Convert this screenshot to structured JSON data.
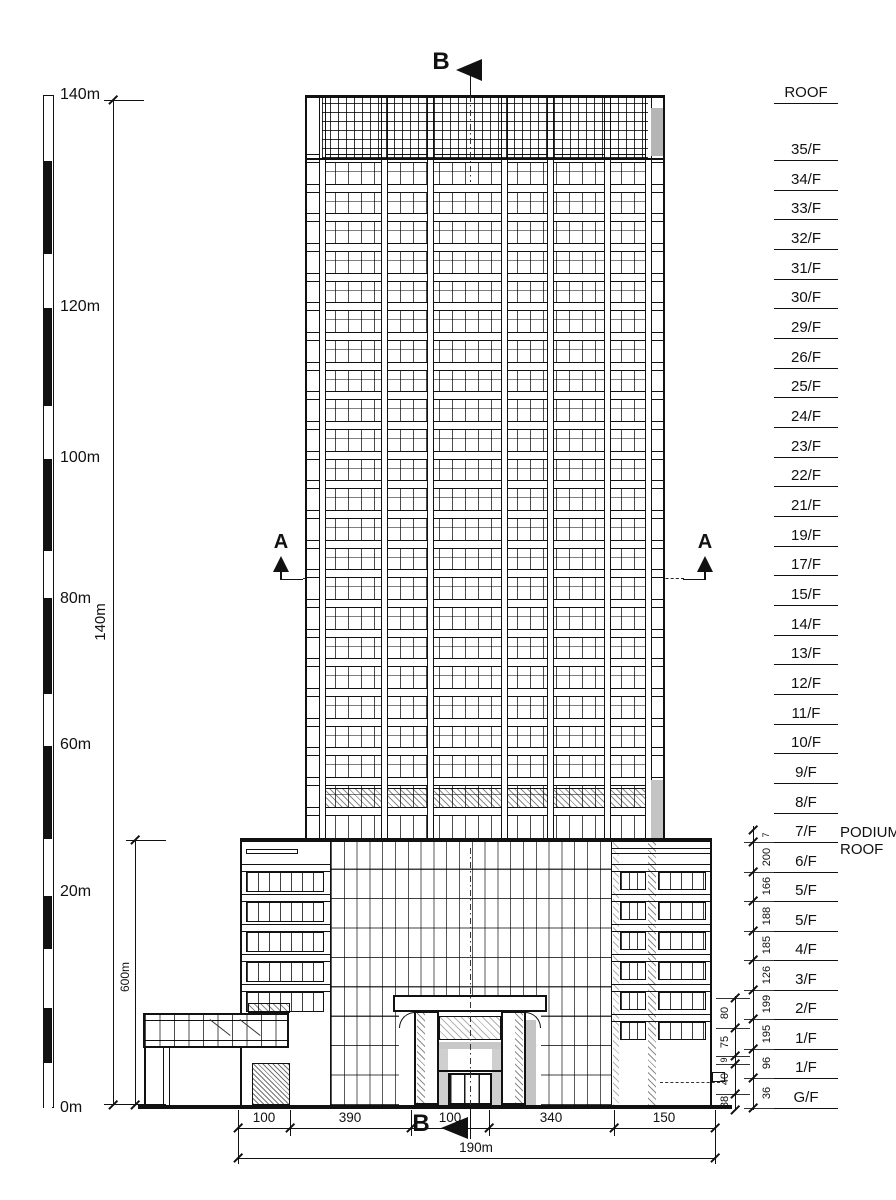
{
  "scale_bar": {
    "unit_labels": [
      {
        "text": "140m",
        "y": 95
      },
      {
        "text": "120m",
        "y": 307
      },
      {
        "text": "100m",
        "y": 458
      },
      {
        "text": "80m",
        "y": 599
      },
      {
        "text": "60m",
        "y": 745
      },
      {
        "text": "20m",
        "y": 892
      },
      {
        "text": "0m",
        "y": 1108
      }
    ],
    "segments": [
      {
        "y": 95,
        "h": 65,
        "fill": "white"
      },
      {
        "y": 160,
        "h": 93,
        "fill": "black"
      },
      {
        "y": 253,
        "h": 54,
        "fill": "white"
      },
      {
        "y": 307,
        "h": 98,
        "fill": "black"
      },
      {
        "y": 405,
        "h": 53,
        "fill": "white"
      },
      {
        "y": 458,
        "h": 92,
        "fill": "black"
      },
      {
        "y": 550,
        "h": 47,
        "fill": "white"
      },
      {
        "y": 597,
        "h": 96,
        "fill": "black"
      },
      {
        "y": 693,
        "h": 52,
        "fill": "white"
      },
      {
        "y": 745,
        "h": 93,
        "fill": "black"
      },
      {
        "y": 838,
        "h": 57,
        "fill": "white"
      },
      {
        "y": 895,
        "h": 53,
        "fill": "black"
      },
      {
        "y": 948,
        "h": 59,
        "fill": "white"
      },
      {
        "y": 1007,
        "h": 55,
        "fill": "black"
      },
      {
        "y": 1062,
        "h": 46,
        "fill": "white"
      }
    ]
  },
  "height_dimensions": [
    {
      "label": "140m",
      "x": 113,
      "y1": 100,
      "y2": 1105,
      "label_cx": 100,
      "label_cy": 622,
      "font": 15
    },
    {
      "label": "600m",
      "x": 135,
      "y1": 840,
      "y2": 1105,
      "label_cx": 126,
      "label_cy": 977,
      "font": 12
    }
  ],
  "floor_labels": [
    {
      "text": "ROOF",
      "y": 103
    },
    {
      "text": "35/F",
      "y": 160
    },
    {
      "text": "34/F",
      "y": 190
    },
    {
      "text": "33/F",
      "y": 219
    },
    {
      "text": "32/F",
      "y": 249
    },
    {
      "text": "31/F",
      "y": 279
    },
    {
      "text": "30/F",
      "y": 308
    },
    {
      "text": "29/F",
      "y": 338
    },
    {
      "text": "26/F",
      "y": 368
    },
    {
      "text": "25/F",
      "y": 397
    },
    {
      "text": "24/F",
      "y": 427
    },
    {
      "text": "23/F",
      "y": 457
    },
    {
      "text": "22/F",
      "y": 486
    },
    {
      "text": "21/F",
      "y": 516
    },
    {
      "text": "19/F",
      "y": 546
    },
    {
      "text": "17/F",
      "y": 575
    },
    {
      "text": "15/F",
      "y": 605
    },
    {
      "text": "14/F",
      "y": 635
    },
    {
      "text": "13/F",
      "y": 664
    },
    {
      "text": "12/F",
      "y": 694
    },
    {
      "text": "11/F",
      "y": 724
    },
    {
      "text": "10/F",
      "y": 753
    },
    {
      "text": "9/F",
      "y": 783
    },
    {
      "text": "8/F",
      "y": 813
    },
    {
      "text": "7/F",
      "y": 842
    },
    {
      "text": "6/F",
      "y": 872
    },
    {
      "text": "5/F",
      "y": 901
    },
    {
      "text": "5/F",
      "y": 931
    },
    {
      "text": "4/F",
      "y": 960
    },
    {
      "text": "3/F",
      "y": 990
    },
    {
      "text": "2/F",
      "y": 1019
    },
    {
      "text": "1/F",
      "y": 1049
    },
    {
      "text": "1/F",
      "y": 1078
    },
    {
      "text": "G/F",
      "y": 1108
    }
  ],
  "podium_roof_note": {
    "line1": "PODIUM",
    "line2": "ROOF"
  },
  "right_inner_chain": {
    "x": 753,
    "y1": 826,
    "y2": 1110,
    "ticks": [
      830,
      842,
      872,
      901,
      931,
      960,
      990,
      1019,
      1049,
      1078,
      1108
    ],
    "ext_lines": [
      842,
      872,
      901,
      931,
      960,
      990,
      1019,
      1049,
      1078,
      1108
    ],
    "values": [
      {
        "text": "7",
        "y": 835,
        "small": true
      },
      {
        "text": "200",
        "y": 857
      },
      {
        "text": "166",
        "y": 886
      },
      {
        "text": "188",
        "y": 916
      },
      {
        "text": "185",
        "y": 945
      },
      {
        "text": "126",
        "y": 975
      },
      {
        "text": "199",
        "y": 1004
      },
      {
        "text": "195",
        "y": 1034
      },
      {
        "text": "96",
        "y": 1063
      },
      {
        "text": "36",
        "y": 1093
      }
    ]
  },
  "right_outer_chain": {
    "x": 735,
    "y1": 996,
    "y2": 1110,
    "ticks": [
      998,
      1028,
      1056,
      1064,
      1094,
      1110
    ],
    "ext_lines": [
      998,
      1028,
      1056,
      1064,
      1094
    ],
    "values": [
      {
        "text": "80",
        "y": 1013
      },
      {
        "text": "75",
        "y": 1042
      },
      {
        "text": "9",
        "y": 1060,
        "small": true
      },
      {
        "text": "40",
        "y": 1079
      },
      {
        "text": "38",
        "y": 1102
      }
    ]
  },
  "bottom_dimensions": {
    "row1_y": 1128,
    "row2_y": 1158,
    "ticks": [
      238,
      290,
      411,
      489,
      614,
      715
    ],
    "segments": [
      {
        "text": "100",
        "cx": 264
      },
      {
        "text": "390",
        "cx": 350
      },
      {
        "text": "100",
        "cx": 450
      },
      {
        "text": "340",
        "cx": 551
      },
      {
        "text": "150",
        "cx": 664
      }
    ],
    "total": {
      "text": "190m",
      "cx": 476
    }
  },
  "section_markers": {
    "top_label": "B",
    "bottom_label": "B",
    "left_label": "A",
    "right_label": "A"
  },
  "drawing": {
    "tower": {
      "x": 305,
      "y": 95,
      "w": 360,
      "h": 743,
      "floor_lines": [
        160,
        190,
        219,
        249,
        279,
        308,
        338,
        368,
        397,
        427,
        457,
        486,
        516,
        546,
        575,
        605,
        635,
        664,
        694,
        724,
        753,
        783,
        813
      ],
      "bay_columns": [
        322,
        384,
        430,
        504,
        550,
        607,
        648
      ]
    },
    "podium": {
      "x": 240,
      "y": 838,
      "w": 472,
      "h": 267,
      "left_window_rows": [
        872,
        902,
        932,
        962,
        992
      ],
      "right_window_rows": [
        872,
        902,
        932,
        962,
        992,
        1022
      ]
    },
    "ground": {
      "x": 138,
      "y": 1105,
      "w": 594
    }
  },
  "colors": {
    "line": "#1a1a1a",
    "shade": "#c4c4c4",
    "shade_dark": "#b5b5b5"
  }
}
